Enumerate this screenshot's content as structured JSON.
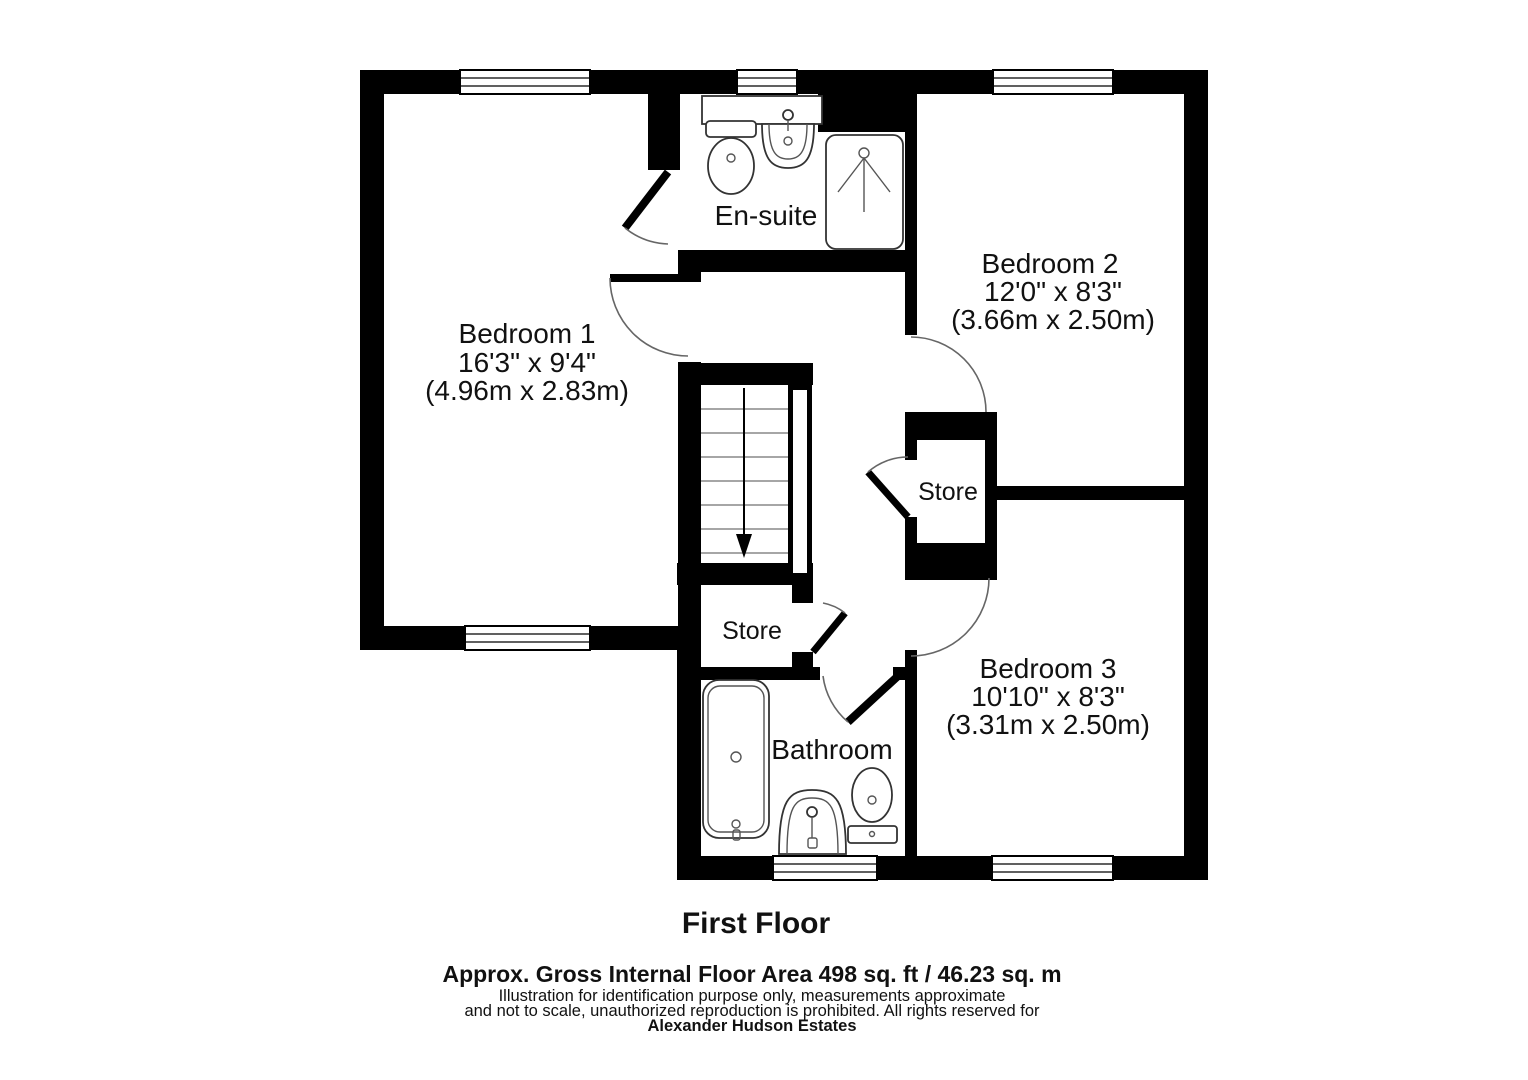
{
  "rooms": {
    "bedroom1": {
      "name": "Bedroom 1",
      "imperial": "16'3\" x 9'4\"",
      "metric": "(4.96m x 2.83m)"
    },
    "bedroom2": {
      "name": "Bedroom 2",
      "imperial": "12'0\" x 8'3\"",
      "metric": "(3.66m x 2.50m)"
    },
    "bedroom3": {
      "name": "Bedroom 3",
      "imperial": "10'10\" x 8'3\"",
      "metric": "(3.31m x 2.50m)"
    },
    "ensuite": {
      "name": "En-suite"
    },
    "bathroom": {
      "name": "Bathroom"
    },
    "store_center": {
      "name": "Store"
    },
    "store_left": {
      "name": "Store"
    }
  },
  "footer": {
    "floor_title": "First Floor",
    "area_line": "Approx. Gross Internal Floor Area 498 sq. ft / 46.23 sq. m",
    "disclaimer_line1": "Illustration for identification purpose only, measurements approximate",
    "disclaimer_line2": "and not to scale, unauthorized reproduction is prohibited. All rights reserved for",
    "agency": "Alexander Hudson Estates"
  },
  "colors": {
    "wall": "#000000",
    "background": "#ffffff"
  }
}
